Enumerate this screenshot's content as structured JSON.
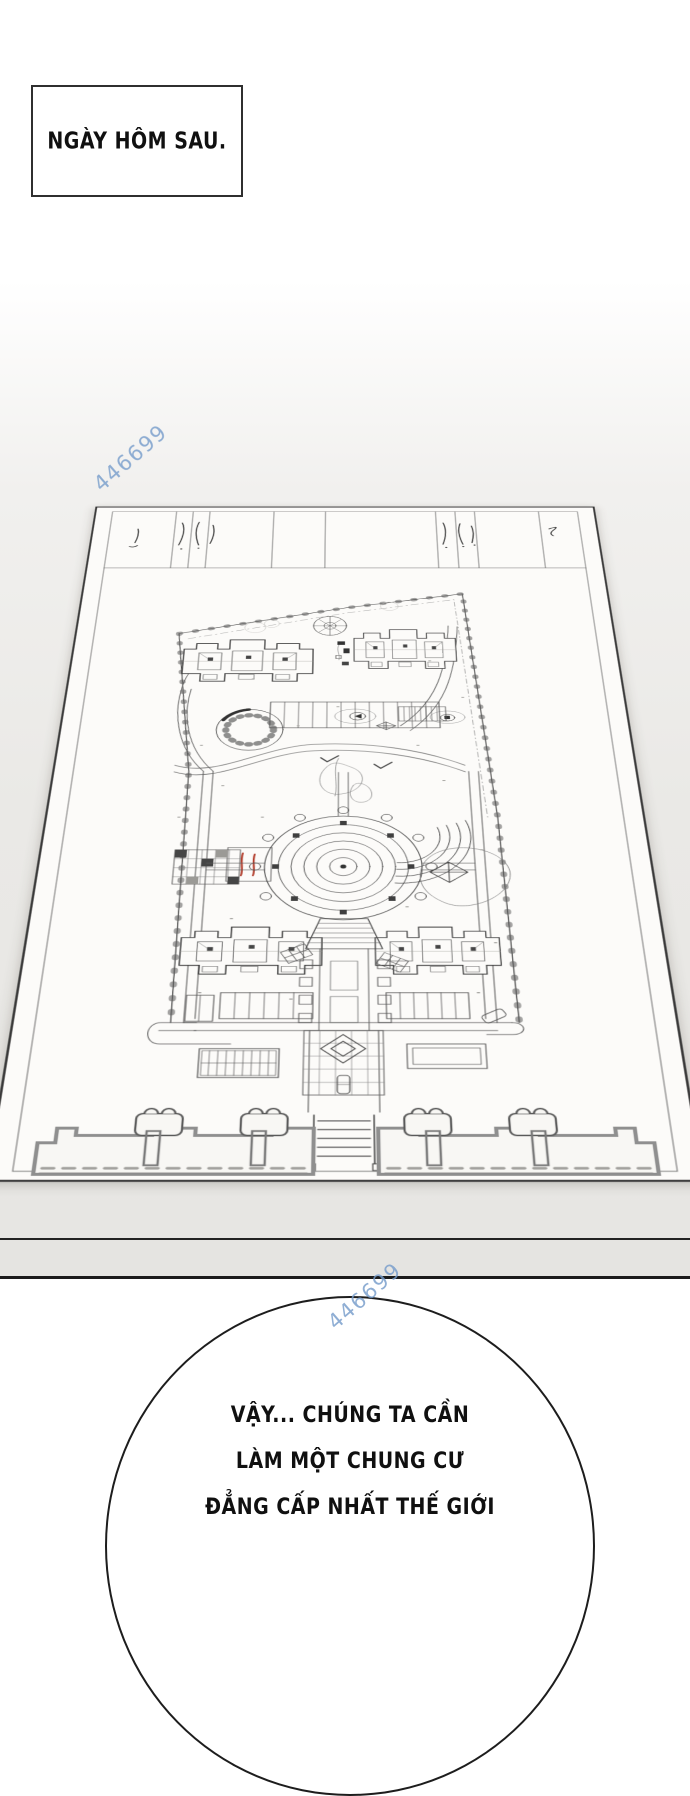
{
  "panel": {
    "caption": "NGÀY HÔM SAU."
  },
  "watermark": {
    "text": "446699",
    "color": "#769cca"
  },
  "speech_bubble": {
    "lines": [
      "VẬY... CHÚNG TA CẦN",
      "LÀM MỘT CHUNG CƯ",
      "ĐẲNG CẤP NHẤT THẾ GIỚI"
    ]
  },
  "colors": {
    "page_background": "#ffffff",
    "floor_gray": "#e9e8e5",
    "paper": "#fcfbf9",
    "ink": "#3c3c3c",
    "panel_line": "#1c1c1c",
    "accent_red": "#b23b2a",
    "watermark_blue": "#769cca"
  }
}
